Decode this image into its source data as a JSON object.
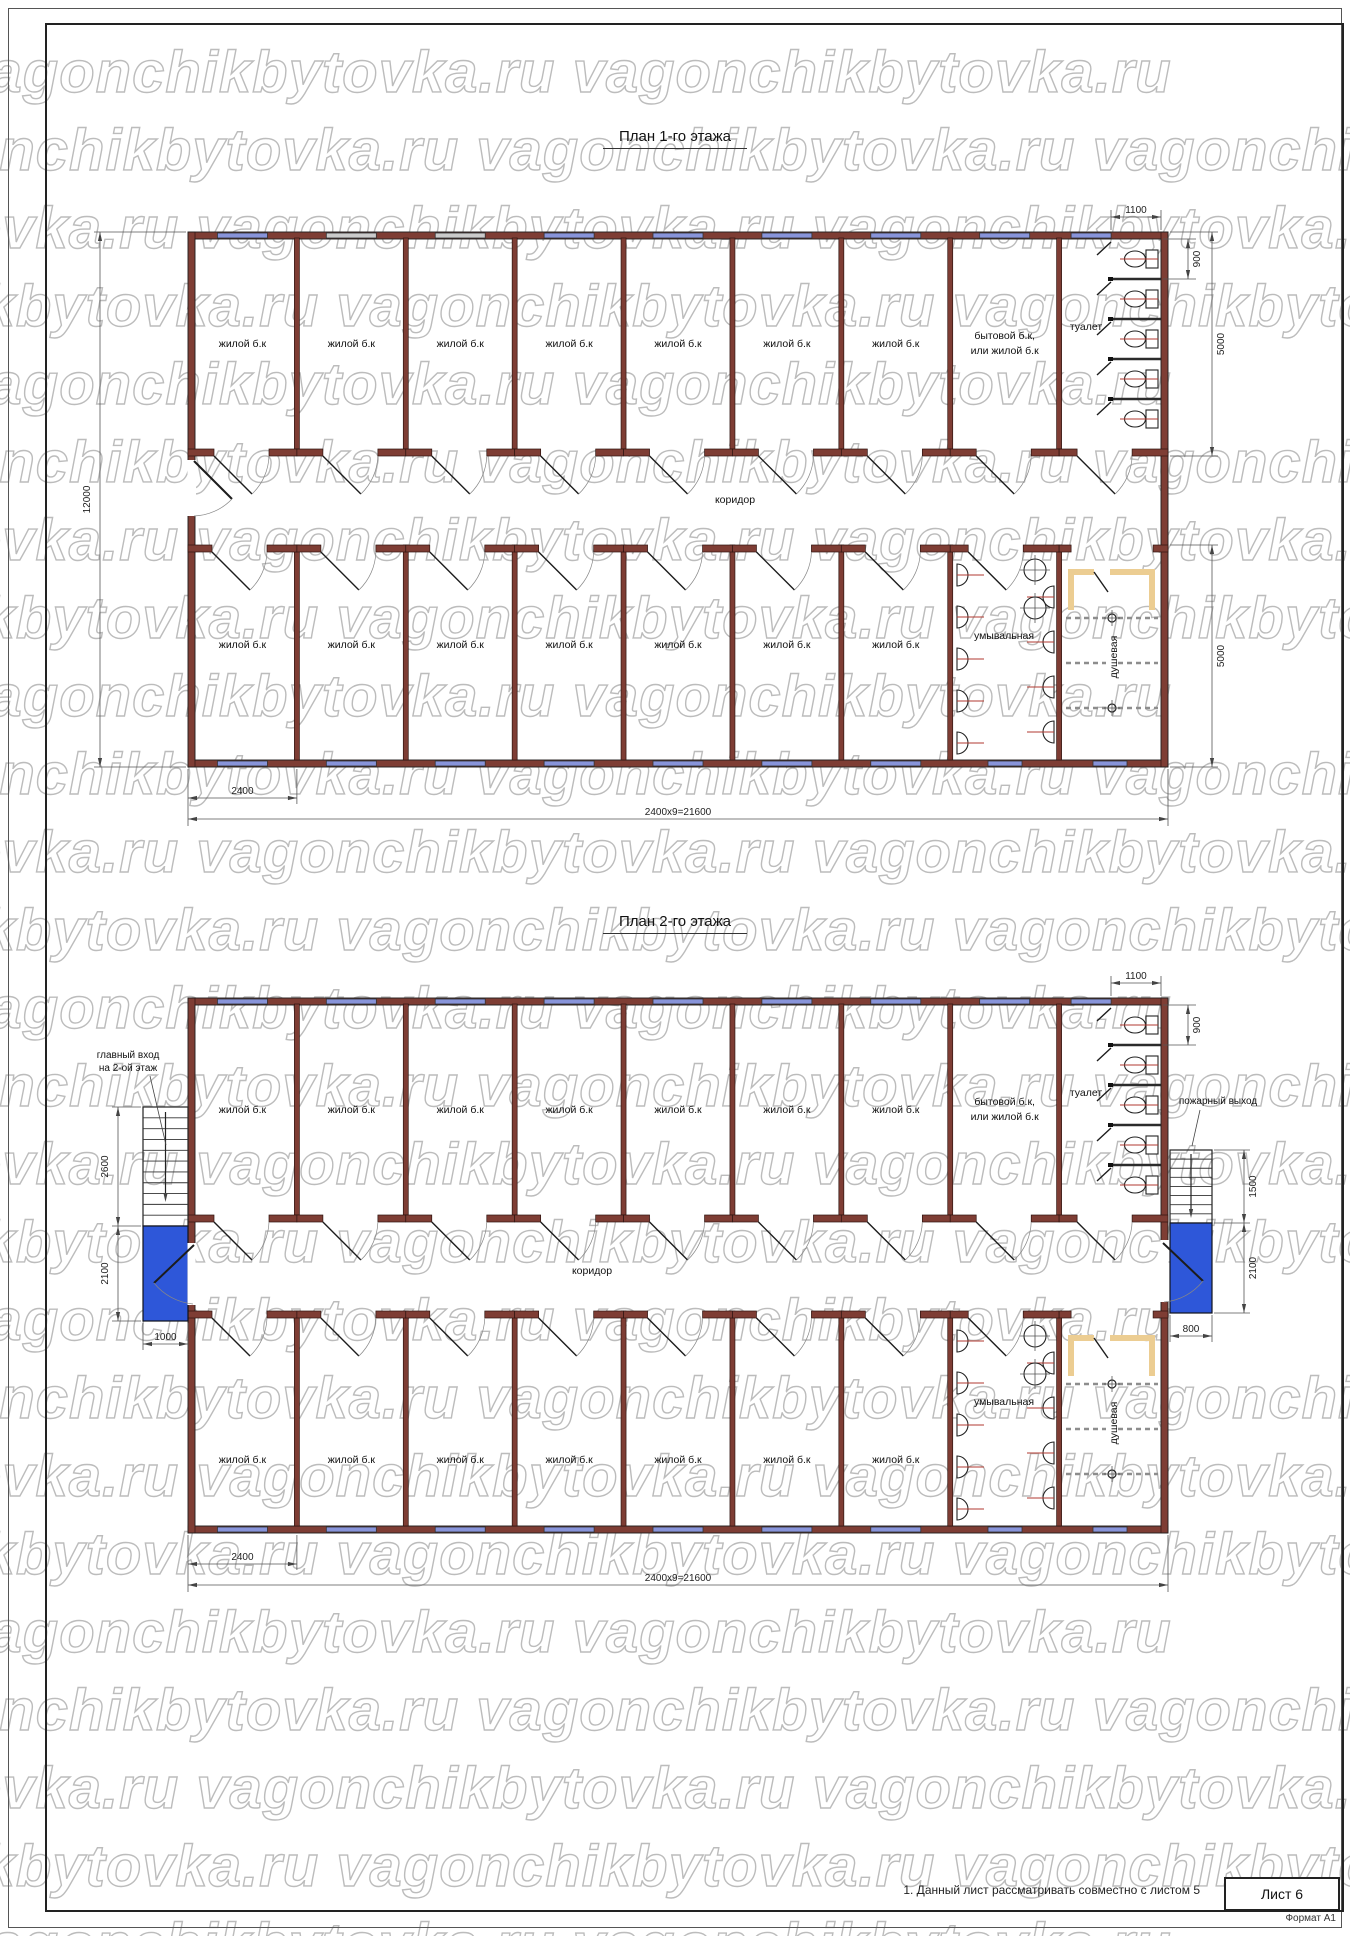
{
  "watermark": {
    "text": "vagonchikbytovka.ru"
  },
  "colors": {
    "wall": "#7e3d34",
    "window_blue": "#8894da",
    "window_gray": "#cbcbcb",
    "landing_blue": "#2e57d9",
    "partition_tan": "#eccd92",
    "fixture_line_red": "#b03a30"
  },
  "plans": [
    {
      "title": "План 1-го этажа",
      "top_rooms": [
        "жилой б.к",
        "жилой б.к",
        "жилой б.к",
        "жилой б.к",
        "жилой б.к",
        "жилой б.к",
        "жилой б.к"
      ],
      "utility_room": [
        "бытовой б.к,",
        "или жилой б.к"
      ],
      "bottom_rooms": [
        "жилой б.к",
        "жилой б.к",
        "жилой б.к",
        "жилой б.к",
        "жилой б.к",
        "жилой б.к",
        "жилой б.к"
      ],
      "toilet": "туалет",
      "washroom": "умывальная",
      "shower": "душевая",
      "corridor": "коридор",
      "dims": {
        "stall_width": "1100",
        "stall_depth": "900",
        "upper_depth": "5000",
        "lower_depth": "5000",
        "total_depth": "12000",
        "module": "2400",
        "total_width": "2400x9=21600"
      }
    },
    {
      "title": "План 2-го этажа",
      "top_rooms": [
        "жилой б.к",
        "жилой б.к",
        "жилой б.к",
        "жилой б.к",
        "жилой б.к",
        "жилой б.к",
        "жилой б.к"
      ],
      "utility_room": [
        "бытовой б.к,",
        "или жилой б.к"
      ],
      "bottom_rooms": [
        "жилой б.к",
        "жилой б.к",
        "жилой б.к",
        "жилой б.к",
        "жилой б.к",
        "жилой б.к",
        "жилой б.к"
      ],
      "toilet": "туалет",
      "washroom": "умывальная",
      "shower": "душевая",
      "corridor": "коридор",
      "annotations": {
        "main_entrance": [
          "главный вход",
          "на 2-ой этаж"
        ],
        "fire_exit": "пожарный выход"
      },
      "dims": {
        "stall_width": "1100",
        "stall_depth": "900",
        "entry_stair": "2600",
        "entry_landing": "2100",
        "entry_width": "1000",
        "fire_stair": "1500",
        "fire_landing": "2100",
        "fire_width": "800",
        "module": "2400",
        "total_width": "2400x9=21600"
      }
    }
  ],
  "footer": {
    "note": "1. Данный лист рассматривать совместно с листом 5",
    "sheet_label": "Лист 6",
    "format_label": "Формат А1"
  }
}
